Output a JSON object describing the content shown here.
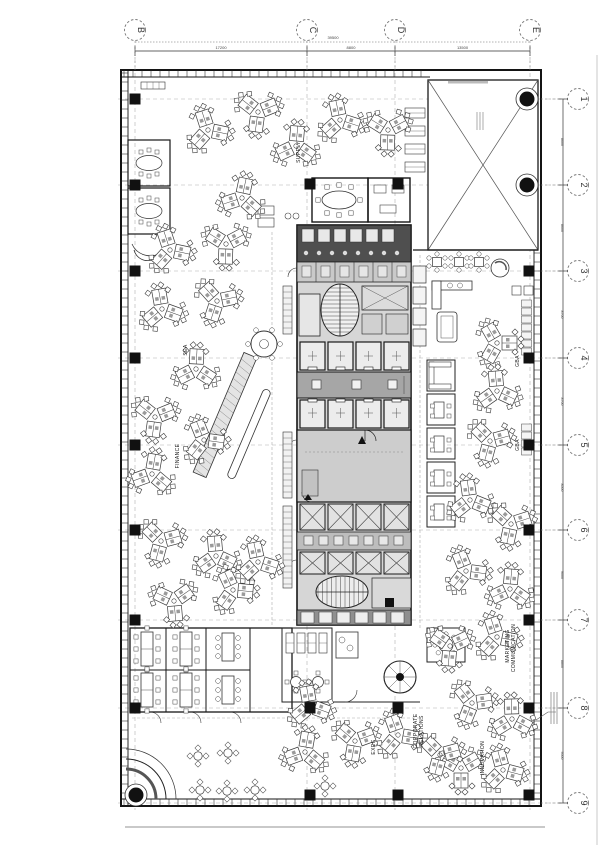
{
  "plan": {
    "colors": {
      "paper": "#ffffff",
      "ink": "#1f1f1f",
      "furn": "#3c3c3c",
      "grid_line": "#b0b0b0",
      "core_fill": "#d6d6d6",
      "core_dark": "#4f4f4f",
      "lobby_fill": "#a6a6a6",
      "shaft_fill": "#e2e2e2",
      "plant_fill": "#cdcdcd",
      "stall_fill": "#8f8f8f",
      "sheet_line": "#c9c9c9"
    },
    "grid": {
      "cols": [
        {
          "label": "B",
          "x": 135
        },
        {
          "label": "C",
          "x": 307
        },
        {
          "label": "D",
          "x": 395
        },
        {
          "label": "E",
          "x": 530
        }
      ],
      "rows": [
        {
          "label": "1",
          "y": 99
        },
        {
          "label": "2",
          "y": 185
        },
        {
          "label": "3",
          "y": 271
        },
        {
          "label": "4",
          "y": 358
        },
        {
          "label": "5",
          "y": 445
        },
        {
          "label": "6",
          "y": 530
        },
        {
          "label": "7",
          "y": 620
        },
        {
          "label": "8",
          "y": 708
        },
        {
          "label": "9",
          "y": 803
        }
      ]
    },
    "dimensions": {
      "overall": "39500",
      "top_segments": [
        "17200",
        "8800",
        "13500"
      ],
      "right_segments": [
        "8600",
        "8600",
        "8700",
        "8700",
        "8500",
        "9000",
        "8800",
        "9500"
      ]
    },
    "labels": [
      {
        "text": "SUPPLY",
        "x": 300,
        "y": 152
      },
      {
        "text": "SEA",
        "x": 187,
        "y": 350
      },
      {
        "text": "FINANCE",
        "x": 179,
        "y": 456
      },
      {
        "text": "EXEC",
        "x": 375,
        "y": 747
      },
      {
        "text": "CORPORATE",
        "x": 417,
        "y": 731
      },
      {
        "text": "RELATIONS",
        "x": 423,
        "y": 731
      },
      {
        "text": "MARKETING",
        "x": 509,
        "y": 646
      },
      {
        "text": "COMMUNICATION",
        "x": 515,
        "y": 648
      },
      {
        "text": "GBA",
        "x": 519,
        "y": 361
      },
      {
        "text": "GBA",
        "x": 519,
        "y": 445
      },
      {
        "text": "INNOVATION",
        "x": 484,
        "y": 758
      }
    ],
    "clusters": [
      [
        208,
        130,
        12
      ],
      [
        258,
        112,
        -22
      ],
      [
        296,
        146,
        35
      ],
      [
        340,
        120,
        18
      ],
      [
        388,
        130,
        -28
      ],
      [
        242,
        198,
        42
      ],
      [
        170,
        250,
        12
      ],
      [
        226,
        244,
        -28
      ],
      [
        162,
        309,
        20
      ],
      [
        217,
        301,
        -12
      ],
      [
        196,
        369,
        33
      ],
      [
        155,
        417,
        -22
      ],
      [
        204,
        440,
        8
      ],
      [
        152,
        474,
        40
      ],
      [
        161,
        541,
        -15
      ],
      [
        216,
        556,
        25
      ],
      [
        174,
        601,
        -35
      ],
      [
        233,
        590,
        5
      ],
      [
        258,
        562,
        18
      ],
      [
        497,
        343,
        0
      ],
      [
        497,
        391,
        25
      ],
      [
        490,
        441,
        -15
      ],
      [
        470,
        500,
        22
      ],
      [
        511,
        524,
        -18
      ],
      [
        466,
        571,
        8
      ],
      [
        510,
        589,
        35
      ],
      [
        450,
        646,
        -25
      ],
      [
        497,
        637,
        12
      ],
      [
        472,
        703,
        -8
      ],
      [
        512,
        719,
        28
      ],
      [
        461,
        768,
        -30
      ],
      [
        503,
        770,
        15
      ],
      [
        310,
        706,
        20
      ],
      [
        355,
        741,
        -20
      ],
      [
        305,
        752,
        40
      ],
      [
        398,
        735,
        10
      ],
      [
        440,
        755,
        -15
      ]
    ],
    "columns": {
      "squares": [
        [
          135,
          99
        ],
        [
          135,
          185
        ],
        [
          135,
          271
        ],
        [
          135,
          358
        ],
        [
          135,
          445
        ],
        [
          135,
          530
        ],
        [
          135,
          620
        ],
        [
          135,
          708
        ],
        [
          310,
          184
        ],
        [
          398,
          184
        ],
        [
          310,
          708
        ],
        [
          398,
          708
        ],
        [
          310,
          795
        ],
        [
          398,
          795
        ],
        [
          529,
          271
        ],
        [
          529,
          358
        ],
        [
          529,
          445
        ],
        [
          529,
          530
        ],
        [
          529,
          620
        ],
        [
          529,
          708
        ],
        [
          529,
          795
        ]
      ],
      "circles": [
        {
          "x": 527,
          "y": 99
        },
        {
          "x": 527,
          "y": 185
        },
        {
          "x": 136,
          "y": 795
        }
      ]
    },
    "cafe_tables": [
      [
        198,
        756
      ],
      [
        228,
        753
      ],
      [
        200,
        790
      ],
      [
        227,
        791
      ],
      [
        255,
        790
      ],
      [
        325,
        786
      ]
    ],
    "cafe_top": [
      [
        437,
        262
      ],
      [
        459,
        262
      ],
      [
        479,
        262
      ]
    ]
  }
}
